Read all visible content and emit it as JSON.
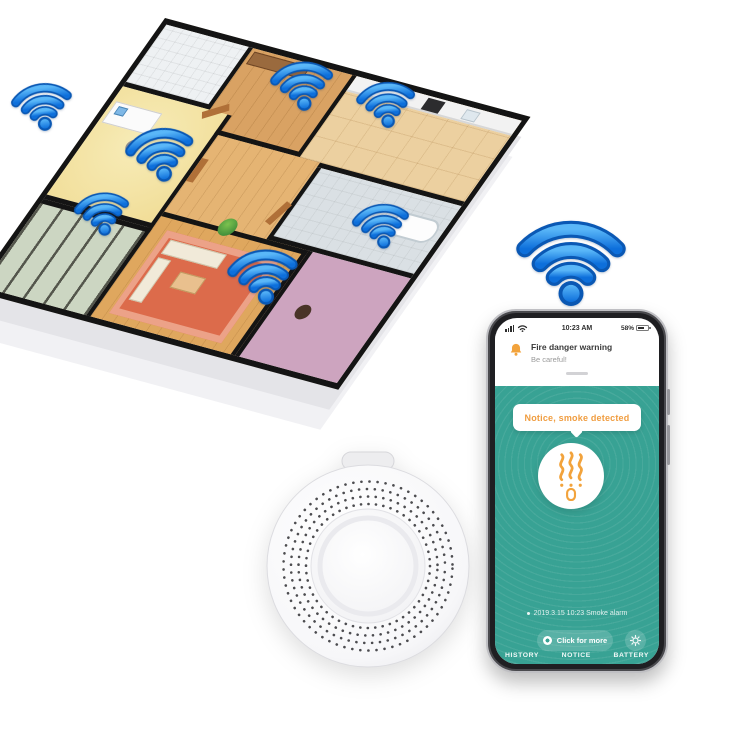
{
  "phone": {
    "status_bar": {
      "time": "10:23 AM",
      "battery_percent": "58%"
    },
    "notification": {
      "title": "Fire danger warning",
      "subtitle": "Be careful!"
    },
    "alert_bubble": {
      "text": "Notice, smoke detected"
    },
    "event": {
      "text": "2019.3.15 10:23 Smoke alarm"
    },
    "more_button": {
      "label": "Click for more"
    },
    "nav": {
      "items": [
        "HISTORY",
        "NOTICE",
        "BATTERY"
      ]
    }
  },
  "colors": {
    "app_teal": "#38a294",
    "accent_orange": "#f09d40",
    "wifi_blue": "#2e8fe8",
    "wall_black": "#141414"
  }
}
